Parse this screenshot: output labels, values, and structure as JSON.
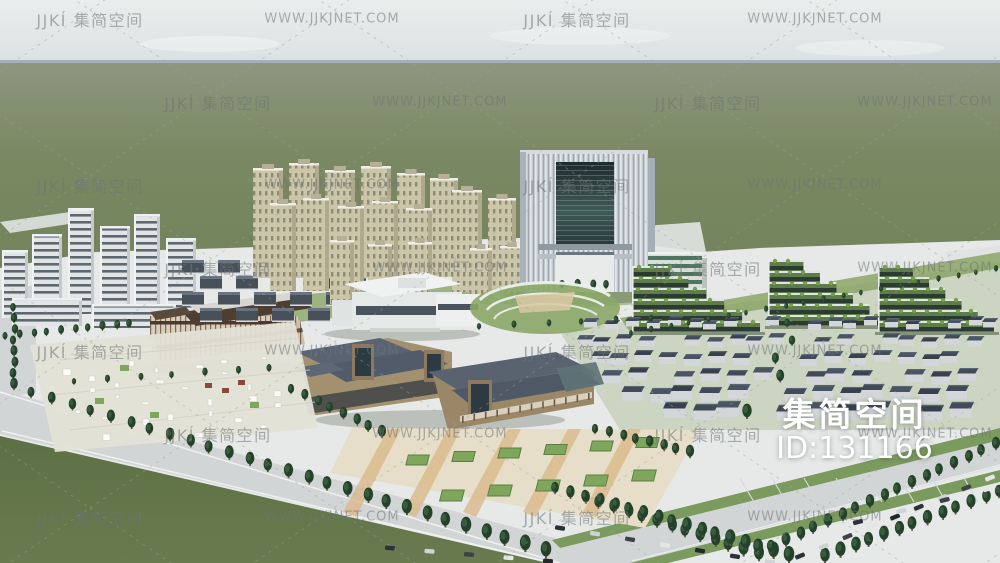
{
  "overlay": {
    "brand_large": "集简空间",
    "id_text": "ID:131166"
  },
  "watermark": {
    "brand": "JJKÍ 集简空间",
    "url": "WWW.JJKJNET.COM"
  },
  "colors": {
    "sky_top": "#e9eceb",
    "sky_bottom": "#dce2e4",
    "horizon": "#8e9aa3",
    "grass_back": "#8d9780",
    "grass_mid": "#75855c",
    "grass_front": "#687a4e",
    "grass_corner": "#5d7045",
    "site": "#e7e9e9",
    "road": "#d2d5d6",
    "verge_green": "#7b9a5d",
    "lawn": "#8fa96d",
    "tree_dark": "#24422a",
    "tree_light": "#3d6040",
    "residential": "#cbc5aa",
    "office_wall": "#e2e5e6",
    "office_glass": "#47525c",
    "tower_body": "#c4cbd1",
    "tower_glass": "#2c3a3d",
    "terraced_green": "#5d7c4a",
    "terraced_dark": "#2c3a34",
    "roof_dark": "#596372",
    "house_roof": "#414b58",
    "house_wall": "#d3d7da",
    "timber": "#6b4f3a",
    "paving_tan": "#d9b98b",
    "planter_green": "#7fa75c",
    "watermark_gray": "rgba(110,117,117,0.55)",
    "id_white": "#ffffff"
  }
}
